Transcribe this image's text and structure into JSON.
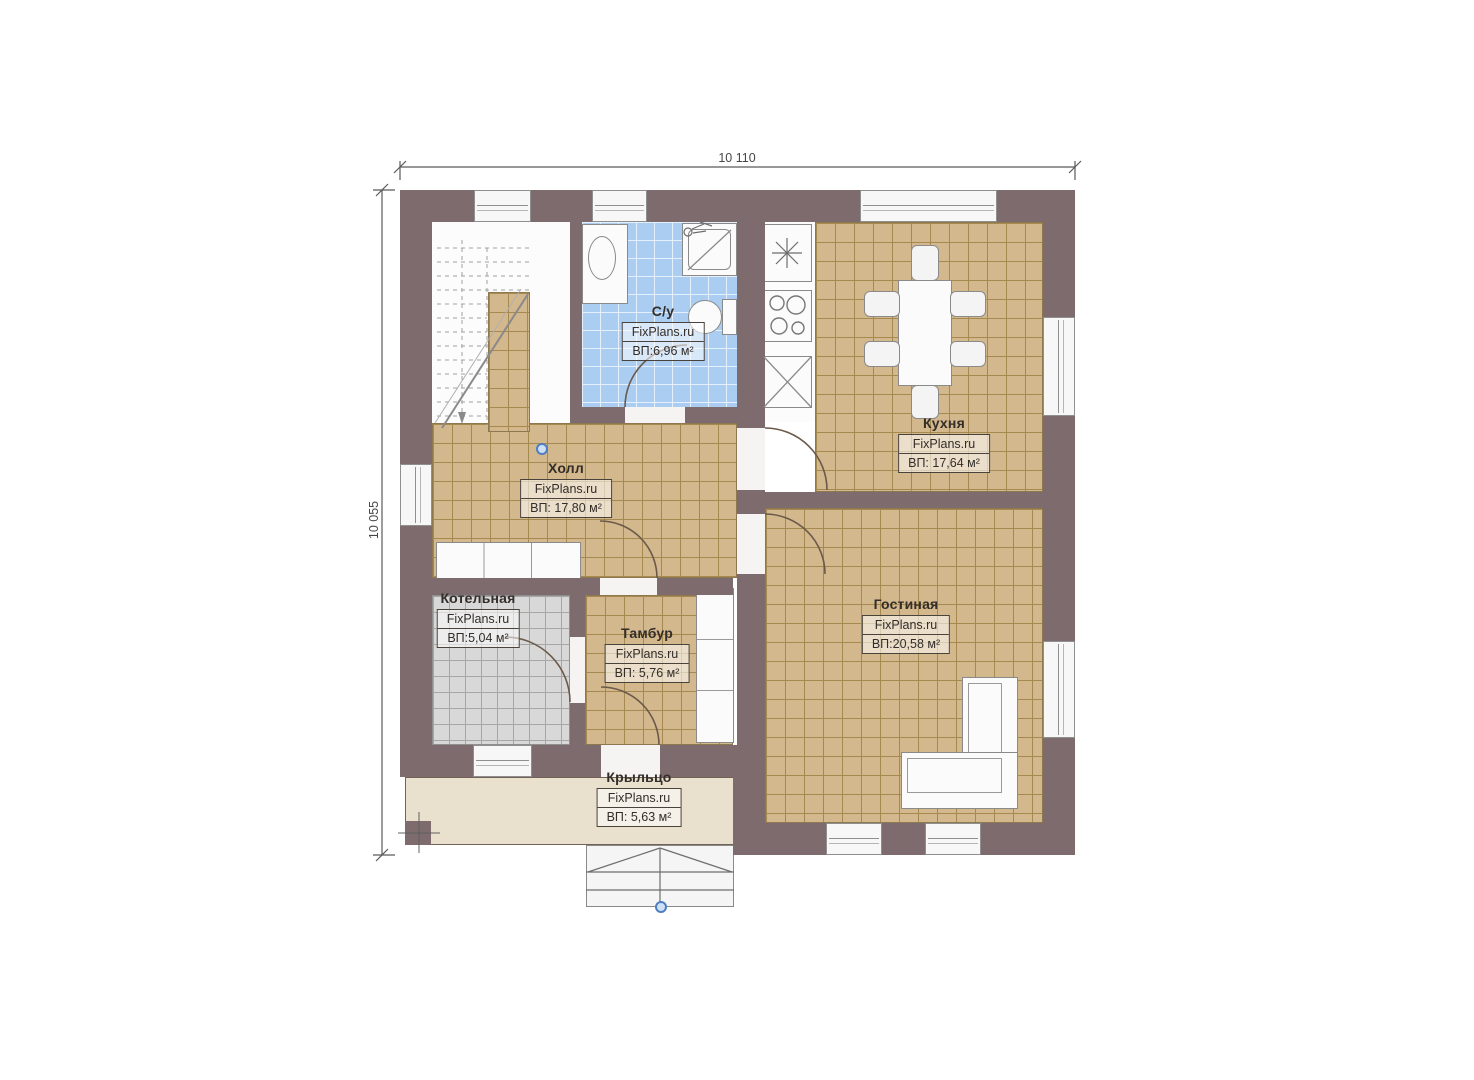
{
  "title": "План 1 этажа",
  "dimensions": {
    "top": "10 110",
    "left": "10 055"
  },
  "rooms": {
    "bathroom": {
      "name": "С/у",
      "brand": "FixPlans.ru",
      "area": "ВП:6,96 м²"
    },
    "kitchen": {
      "name": "Кухня",
      "brand": "FixPlans.ru",
      "area": "ВП: 17,64 м²"
    },
    "hall": {
      "name": "Холл",
      "brand": "FixPlans.ru",
      "area": "ВП: 17,80 м²"
    },
    "boiler": {
      "name": "Котельная",
      "brand": "FixPlans.ru",
      "area": "ВП:5,04 м²"
    },
    "vestibule": {
      "name": "Тамбур",
      "brand": "FixPlans.ru",
      "area": "ВП: 5,76 м²"
    },
    "living": {
      "name": "Гостиная",
      "brand": "FixPlans.ru",
      "area": "ВП:20,58 м²"
    },
    "porch": {
      "name": "Крыльцо",
      "brand": "FixPlans.ru",
      "area": "ВП: 5,63 м²"
    }
  },
  "colors": {
    "wall": "#7e6b6d",
    "floor-tan": "#d3b78d",
    "grid-tan": "#a5894f",
    "floor-blue": "#aacdf1",
    "grid-blue": "#e4f0fb",
    "floor-gray": "#d8d8d8",
    "grid-gray": "#a6a6a6",
    "porch": "#e9e1ce",
    "white-fixture": "#fbfbfb",
    "marker-blue": "#4d7fc4",
    "label-ink": "#332e29"
  }
}
